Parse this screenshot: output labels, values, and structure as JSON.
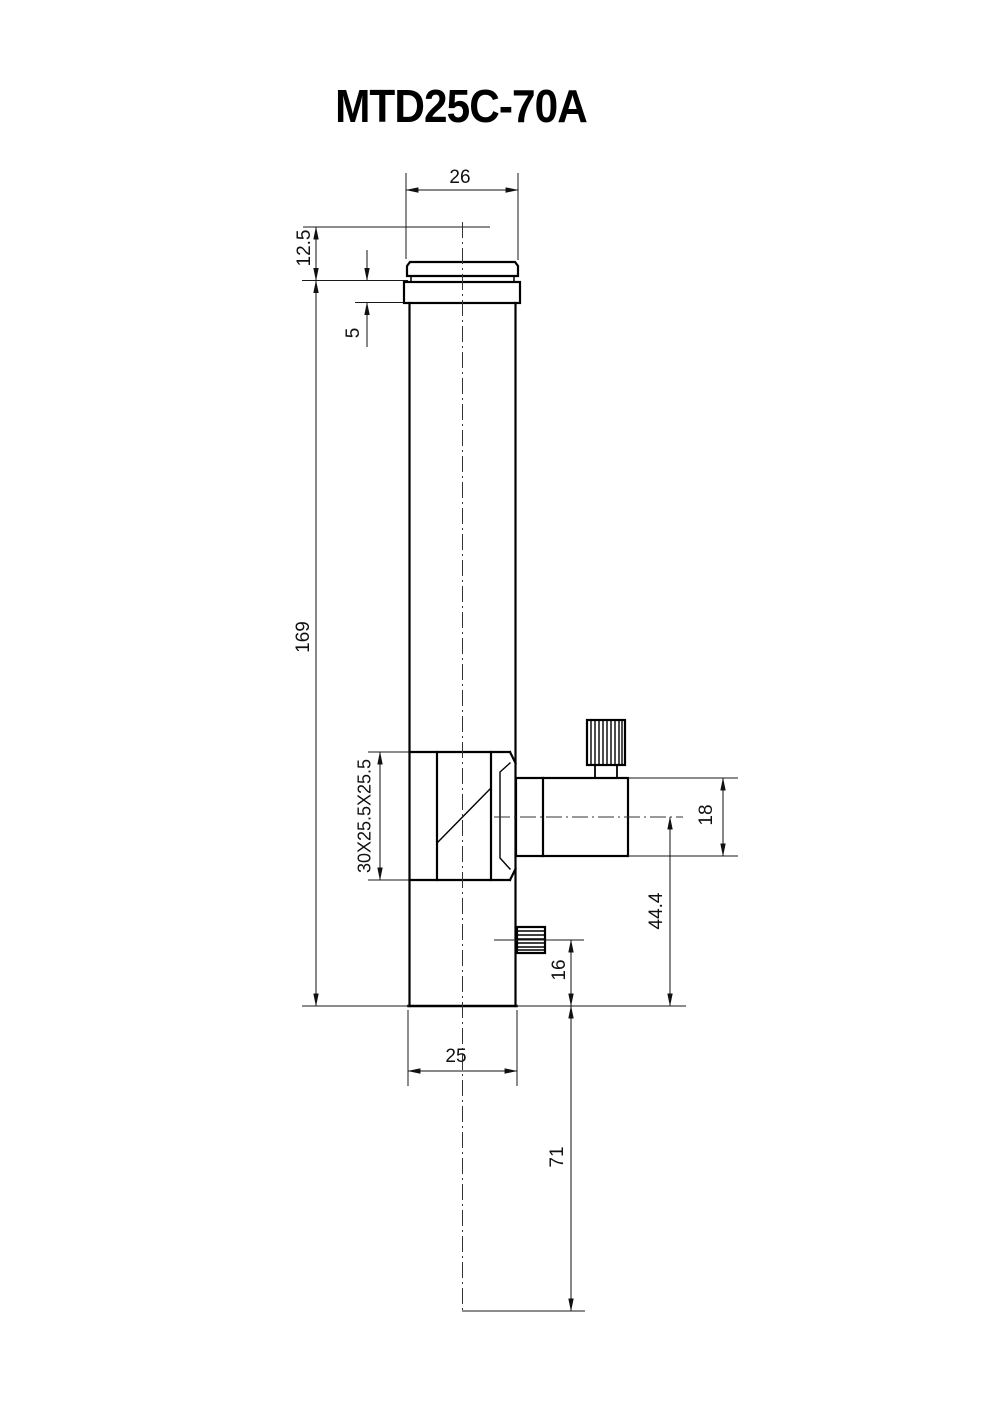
{
  "title": "MTD25C-70A",
  "dims": {
    "d26": "26",
    "d12_5": "12.5",
    "d5": "5",
    "d169": "169",
    "prism": "30X25.5X25.5",
    "d18": "18",
    "d44_4": "44.4",
    "d16": "16",
    "d25": "25",
    "d71": "71"
  }
}
